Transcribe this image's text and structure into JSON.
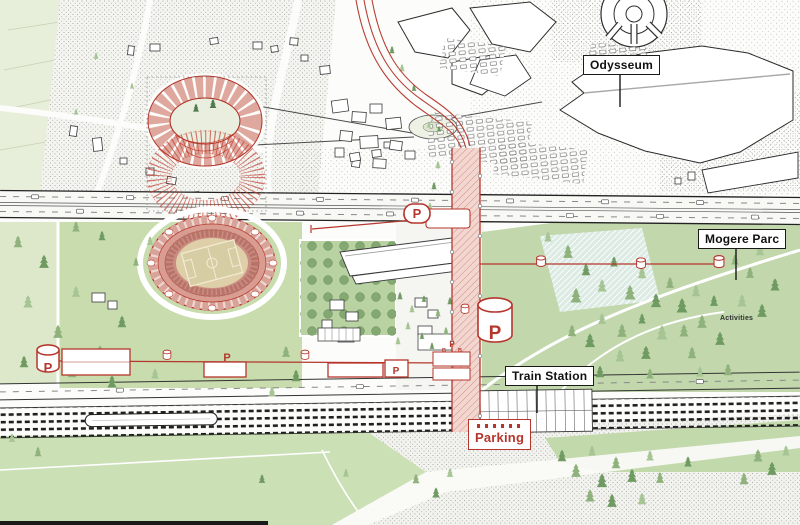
{
  "drawing": {
    "labels": {
      "odysseum": "Odysseum",
      "mogere_parc": "Mogere Parc",
      "train_station": "Train Station",
      "parking": "Parking",
      "activities": "Activities"
    },
    "symbols": {
      "parking_marker": "P",
      "bus_bay": "B"
    },
    "colors": {
      "route_red": "#b5362c",
      "route_fill": "#f2d7d1",
      "label_black": "#1a1a1a",
      "stadium_pink": "#dfa89e",
      "park_green": "#bdd5a6",
      "lawn_green": "#cde0b4",
      "field_green": "#d2e4ba",
      "tree_green": "#8fb27c",
      "stipple_gray": "#a9a9a3"
    }
  }
}
